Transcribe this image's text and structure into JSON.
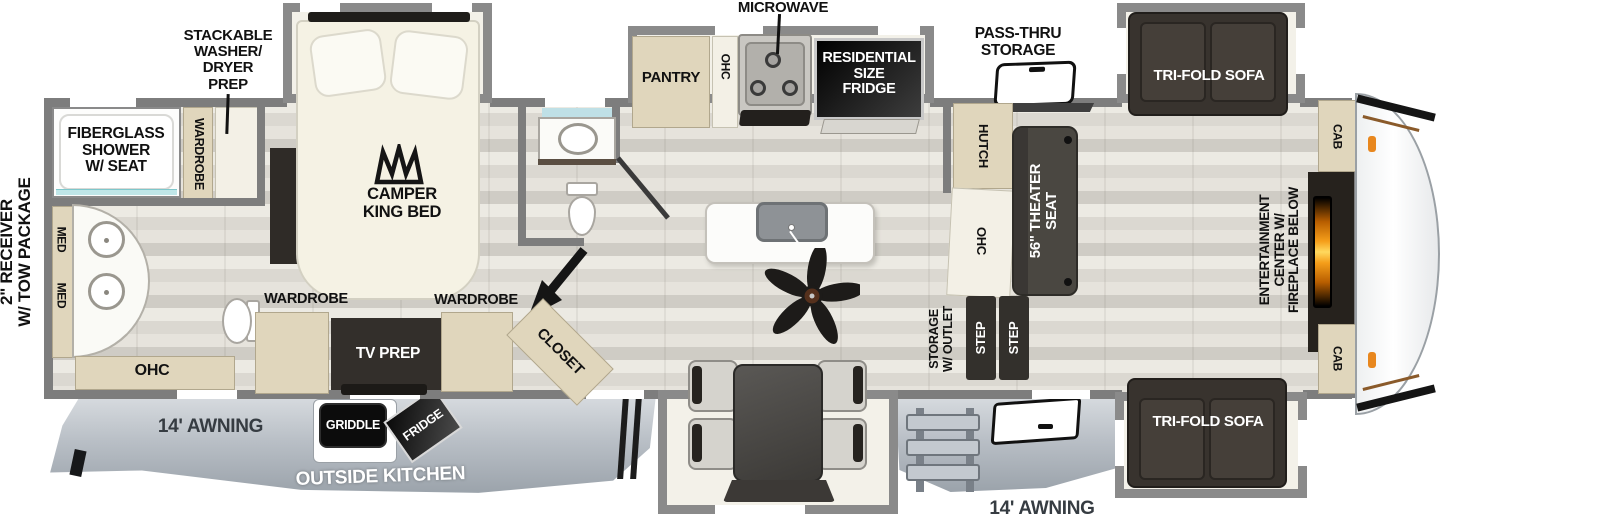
{
  "annotations": {
    "microwave": "MICROWAVE",
    "stackable": [
      "STACKABLE",
      "WASHER/",
      "DRYER",
      "PREP"
    ],
    "pass_thru": [
      "PASS-THRU",
      "STORAGE"
    ],
    "receiver": [
      "2\" RECEIVER",
      "W/ TOW PACKAGE"
    ]
  },
  "rear_bath": {
    "shower": [
      "FIBERGLASS",
      "SHOWER",
      "W/ SEAT"
    ],
    "wardrobe": "WARDROBE",
    "med_top": "MED",
    "med_bottom": "MED",
    "ohc": "OHC"
  },
  "bedroom": {
    "bed": [
      "CAMPER",
      "KING BED"
    ],
    "wardrobe_left": "WARDROBE",
    "wardrobe_right": "WARDROBE",
    "tv_prep": "TV PREP",
    "closet": "CLOSET"
  },
  "kitchen": {
    "pantry": "PANTRY",
    "ohc": "OHC",
    "fridge": [
      "RESIDENTIAL",
      "SIZE",
      "FRIDGE"
    ],
    "hutch": "HUTCH",
    "ohc_hutch": "OHC"
  },
  "living": {
    "theater_seat": [
      "56\" THEATER",
      "SEAT"
    ],
    "storage_outlet": [
      "STORAGE",
      "W/ OUTLET"
    ],
    "step_1": "STEP",
    "step_2": "STEP",
    "sofa_top": "TRI-FOLD SOFA",
    "sofa_bottom": "TRI-FOLD SOFA",
    "entertainment": [
      "ENTERTAINMENT",
      "CENTER W/",
      "FIREPLACE BELOW"
    ],
    "cab_top": "CAB",
    "cab_bottom": "CAB"
  },
  "exterior": {
    "awning_left": "14' AWNING",
    "awning_right": "14' AWNING",
    "outside_kitchen": "OUTSIDE KITCHEN",
    "griddle": "GRIDDLE",
    "fridge": "FRIDGE"
  },
  "colors": {
    "wall": "#7d7d7d",
    "cabinet_tan": "#e0d6bc",
    "dark_furniture": "#332f2b",
    "skirt_gray": "#b9bfc6",
    "fireplace_orange": "#f59e1a",
    "shower_glass_teal": "#bfe6e8"
  }
}
